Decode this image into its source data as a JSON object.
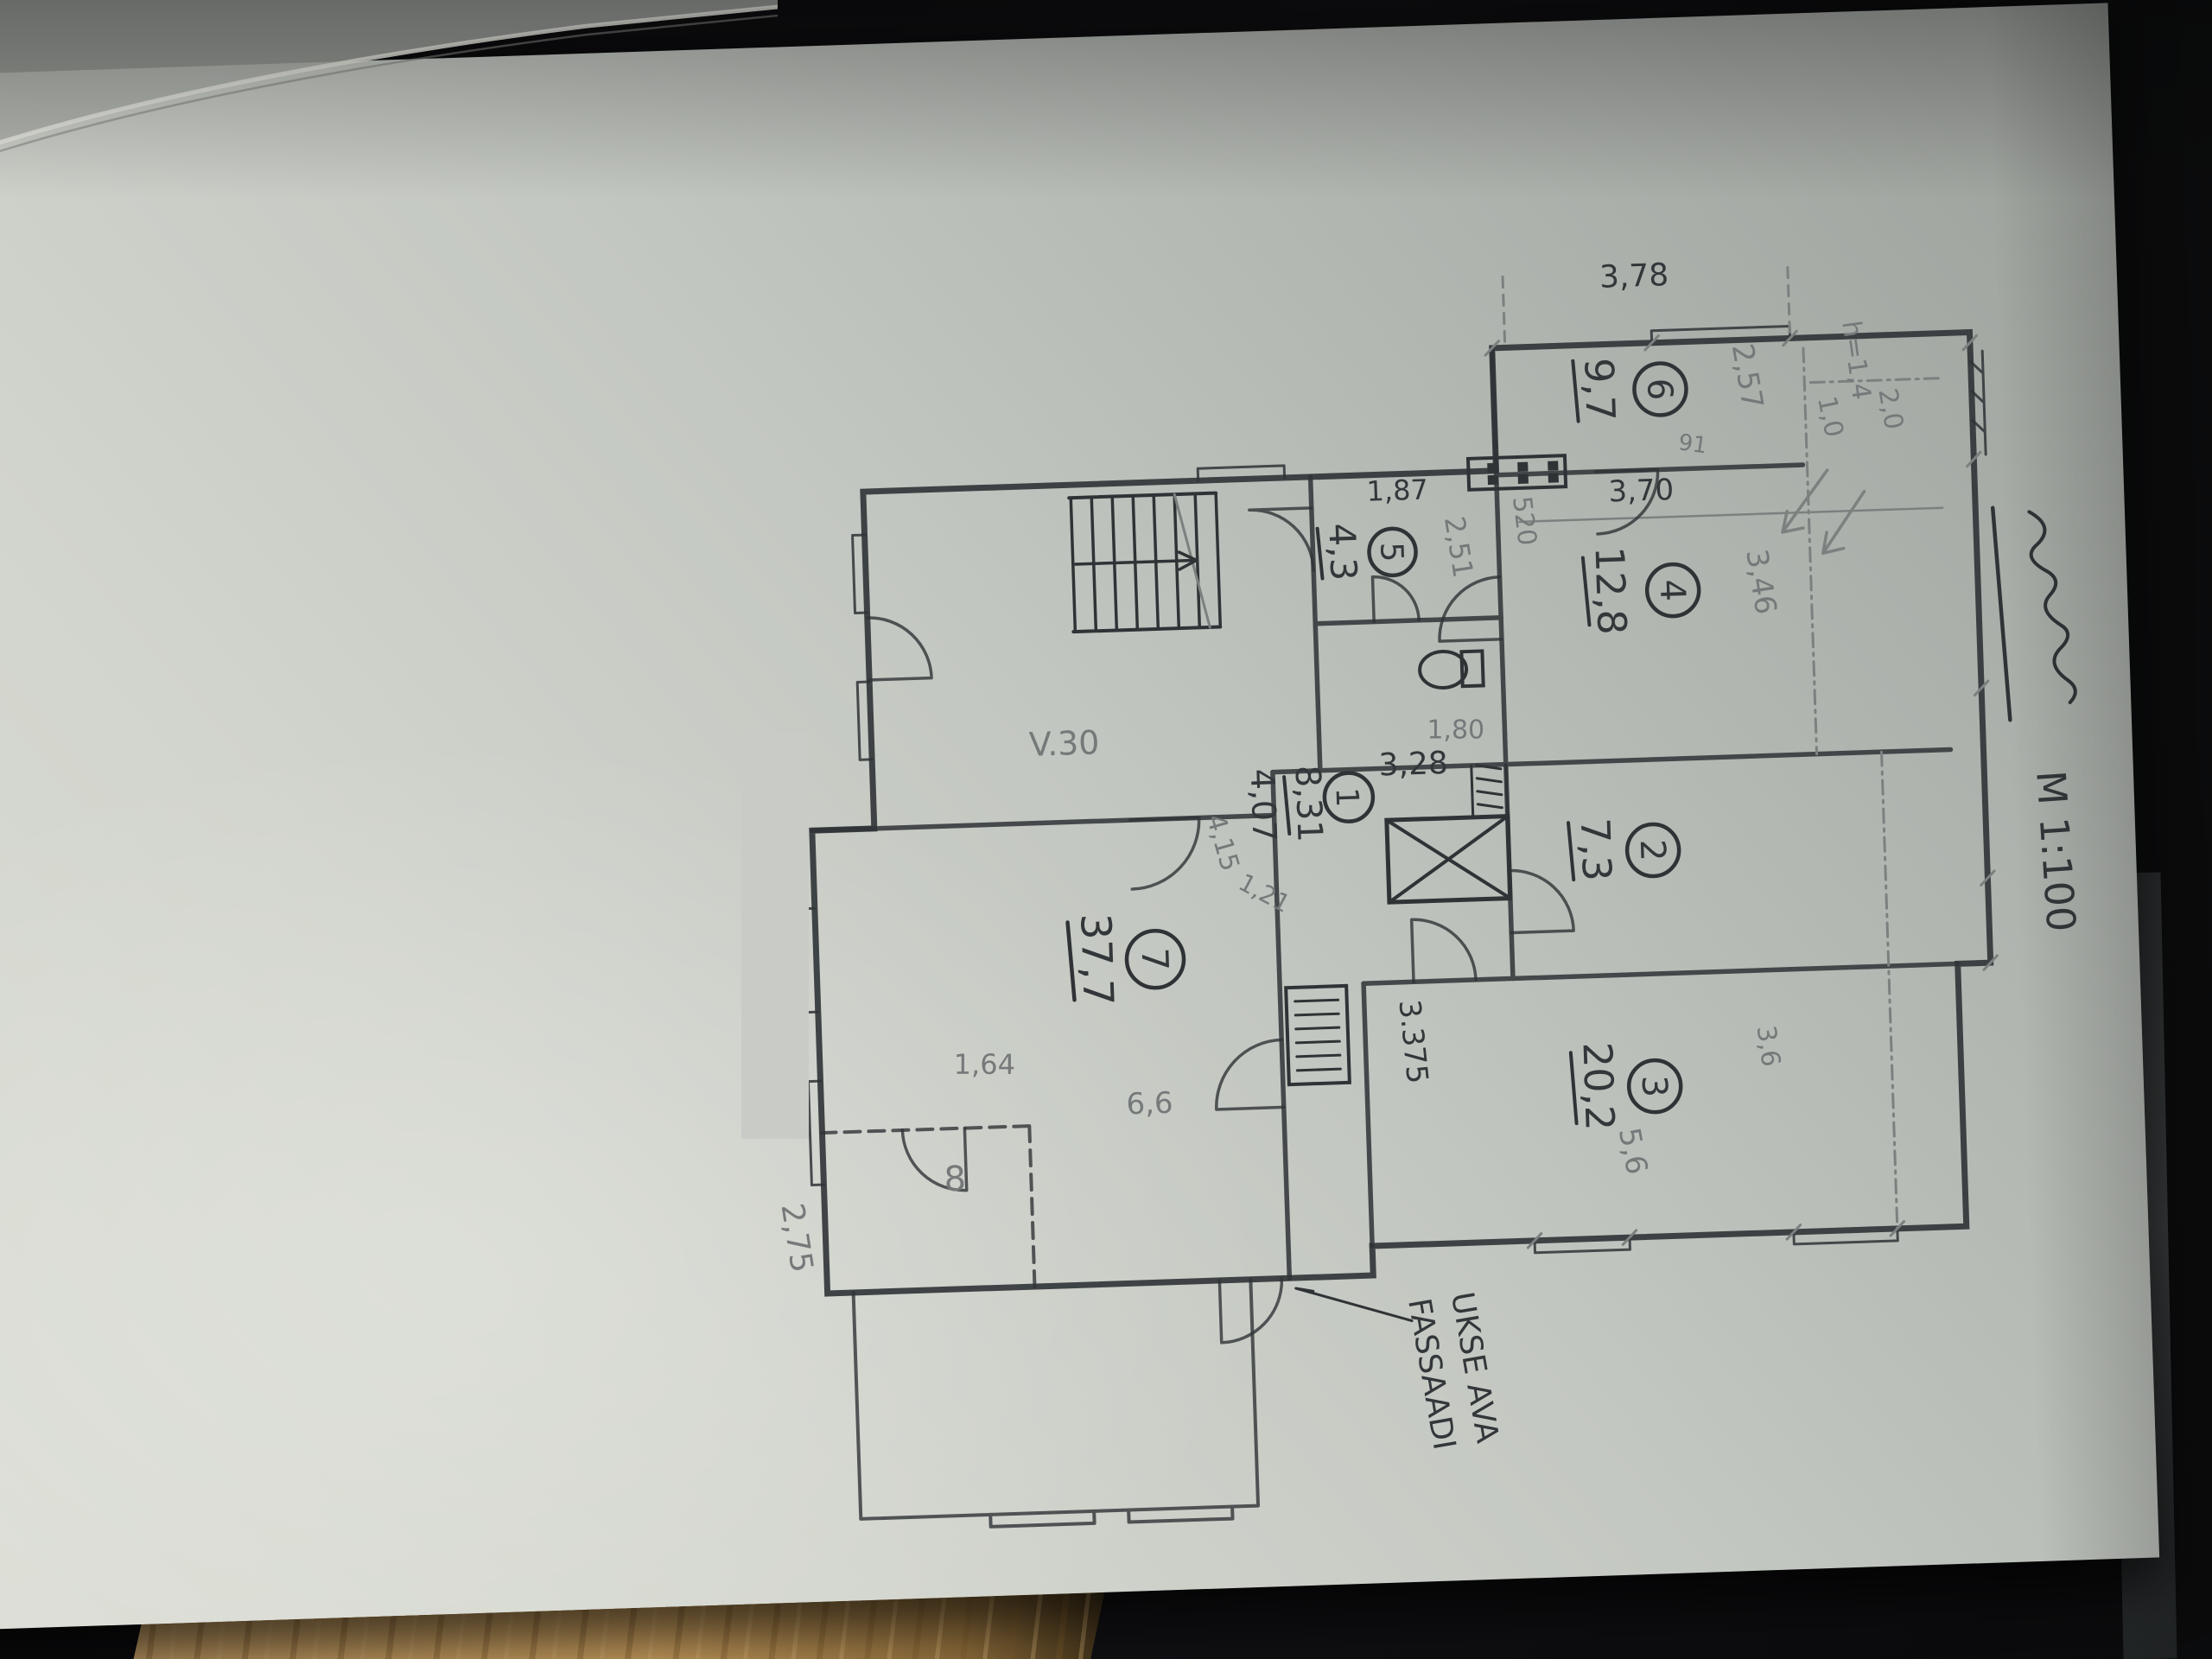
{
  "scene": {
    "background_color": "#0b0b0d",
    "paper_color": "#c3c7c1",
    "wood_color": "#c49a5c",
    "redaction_color": "#c9cbc7",
    "ink_color": "#2f3336",
    "pencil_color": "#7c807f"
  },
  "plan": {
    "scale_label": "M 1:100",
    "facade_note_line1": "UKSE AVA",
    "facade_note_line2": "FASSAADI",
    "rooms": [
      {
        "number": "1",
        "area": "8,31",
        "area_alt": "4,07",
        "dims": [
          "3,28",
          "1,80"
        ]
      },
      {
        "number": "2",
        "area": "7,3",
        "dims": []
      },
      {
        "number": "3",
        "area": "20,2",
        "dims": [
          "3,6",
          "5,6",
          "3.375"
        ]
      },
      {
        "number": "4",
        "area": "12,8",
        "dims": [
          "3,46",
          "3,70",
          "520",
          "91"
        ]
      },
      {
        "number": "5",
        "area": "4,3",
        "dims": [
          "1,87",
          "2,51"
        ]
      },
      {
        "number": "6",
        "area": "9,7",
        "dims": [
          "3,78",
          "2,57",
          "1,0",
          "2,0",
          "h=1,4"
        ]
      },
      {
        "number": "7",
        "area": "37,7",
        "dims": [
          "6,6",
          "1,64",
          "4,15",
          "1,21",
          "V.30",
          "2,75"
        ]
      },
      {
        "number": "8",
        "area": "",
        "dims": []
      }
    ],
    "t": {
      "room1_num": "1",
      "room1_area": "8,31",
      "room1_area2": "4,07",
      "room2_num": "2",
      "room2_area": "7,3",
      "room3_num": "3",
      "room3_area": "20,2",
      "room4_num": "4",
      "room4_area": "12,8",
      "room5_num": "5",
      "room5_area": "4,3",
      "room6_num": "6",
      "room6_area": "9,7",
      "room7_num": "7",
      "room7_area": "37,7",
      "room8_num": "8",
      "dim_328": "3,28",
      "dim_180": "1,80",
      "dim_346": "3,46",
      "dim_370": "3,70",
      "dim_520": "520",
      "dim_91": "91",
      "dim_187": "1,87",
      "dim_251": "2,51",
      "dim_378": "3,78",
      "dim_257": "2,57",
      "dim_10": "1,0",
      "dim_20": "2,0",
      "dim_h": "h=1,4",
      "dim_36": "3,6",
      "dim_56": "5,6",
      "dim_3375": "3.375",
      "dim_66": "6,6",
      "dim_164": "1,64",
      "dim_415": "4,15",
      "dim_121": "1,21",
      "dim_v30": "V.30",
      "dim_275": "2,75",
      "note_line1": "UKSE AVA",
      "note_line2": "FASSAADI",
      "scale": "M 1:100"
    }
  }
}
